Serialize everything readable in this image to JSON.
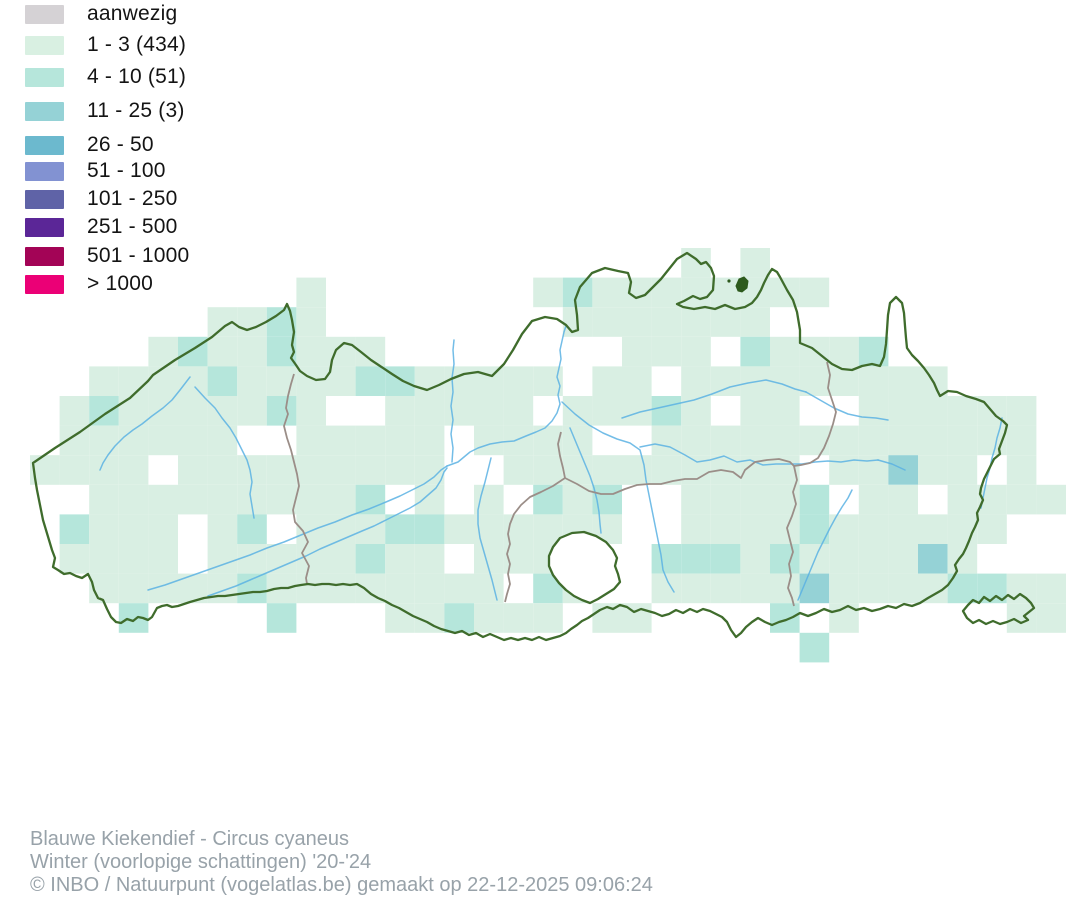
{
  "legend": {
    "items": [
      {
        "label": "aanwezig",
        "color": "#d5d2d5"
      },
      {
        "label": "1 - 3 (434)",
        "color": "#d9f0e2"
      },
      {
        "label": "4 - 10 (51)",
        "color": "#b6e6db"
      },
      {
        "label": "11 - 25 (3)",
        "color": "#95d2d6"
      },
      {
        "label": "26 - 50",
        "color": "#6cb9ce"
      },
      {
        "label": "51 - 100",
        "color": "#8292d2"
      },
      {
        "label": "101 - 250",
        "color": "#5f63a7"
      },
      {
        "label": "251 - 500",
        "color": "#5b2697"
      },
      {
        "label": "501 - 1000",
        "color": "#a30456"
      },
      {
        "label": "> 1000",
        "color": "#eb0076"
      }
    ]
  },
  "footer": {
    "line1": "Blauwe Kiekendief - Circus cyaneus",
    "line2": "Winter (voorlopige schattingen) '20-'24",
    "line3": "© INBO / Natuurpunt (vogelatlas.be) gemaakt op 22-12-2025 09:06:24"
  },
  "map": {
    "colors": {
      "outline": "#3f6c2c",
      "province_border": "#9b8e88",
      "river": "#5ab2e3",
      "forest": "#2d5a1d",
      "enclave_fill": "#ffffff",
      "level1": "#d9efe3",
      "level2": "#b5e6db",
      "level3": "#95d2d6"
    },
    "grid": {
      "x0": 30,
      "y0": 248,
      "size": 29.6,
      "levels": {
        "1": "level1",
        "2": "level2",
        "3": "level3"
      },
      "rows": [
        "......................1.1..........",
        ".........1.......1211111111........",
        "......1121........1111111..........",
        "....12112111........111.21112......",
        "..1111211112211111.11.111111111....",
        ".121111121..11111.11121 11..111111.",
        ".111111..11111.1111..1111111111111.",
        "1111.111111111..1111111111.11311.1.",
        "..1111111112 1.1.212..11112 11.1111..",
        ".2111 12.11122111111..11112111111...",
        ".1111.11111211.111...22212111131...",
        "..11111211111111 21..11111311112211.",
        "...2....2...112111 11....2.1.....11.",
        "..........................2........"
      ]
    },
    "outline": "M 33 463 L 55 448 80 432 105 414 130 398 148 381 153 375 175 360 195 348 212 337 225 326 232 322 239 327 247 330 256 327 266 322 276 316 284 310 287 304 290 311 292 320 294 332 292 345 294 352 291 358 296 365 300 371 307 376 316 380 325 379 330 372 332 360 336 350 344 343 352 345 361 352 371 360 380 366 392 374 403 381 414 386 427 390 439 385 451 379 464 374 478 372 492 376 504 364 513 350 522 334 532 321 545 317 557 319 566 325 572 332 578 330 577 315 575 300 580 287 592 273 605 268 618 271 628 273 631 282 629 293 636 298 645 295 653 287 661 279 669 269 677 259 687 253 696 259 701 264 706 262 711 268 714 276 713 290 707 297 700 299 693 296 684 301 677 304 683 307 694 309 705 307 715 309 725 305 735 309 745 307 752 303 757 297 761 290 764 283 768 275 772 269 777 272 780 277 787 290 793 300 797 312 800 330 800 343 812 348 822 356 832 364 842 369 852 370 862 366 872 364 880 366 884 357 886 344 887 330 888 315 890 303 896 297 902 303 904 313 905 326 906 338 907 348 912 355 918 361 924 368 929 375 934 383 937 390 940 396 948 391 957 392 966 396 976 399 984 402 990 409 996 416 1003 421 1007 425 1005 433 1002 441 999 449 1000 454 994 459 991 465 988 471 984 479 981 488 980 494 983 500 980 507 977 513 978 520 975 527 972 533 969 541 966 548 963 554 959 559 955 565 957 571 953 578 948 585 942 590 935 594 928 598 920 603 912 606 904 604 896 608 888 606 880 609 872 611 864 608 856 610 848 606 840 610 832 612 824 609 816 613 808 616 800 613 793 617 786 620 779 622 772 625 765 622 758 618 752 622 746 627 741 633 736 637 731 630 727 622 722 617 716 614 710 611 703 609 697 612 690 609 683 613 676 610 669 614 662 616 655 613 648 611 641 609 634 612 627 607 620 605 613 609 607 607 600 610 594 614 588 618 582 621 577 625 571 629 566 633 560 636 553 638 546 640 539 637 532 640 525 638 518 640 511 638 504 640 497 637 490 634 483 637 476 633 469 635 462 631 455 633 448 631 441 629 434 626 427 622 420 619 413 616 406 612 399 608 392 605 385 601 378 598 371 594 364 588 357 584 350 585 343 584 336 585 329 584 322 584 315 585 308 584 301 585 295 586 288 588 281 588 274 589 267 591 260 592 253 592 246 593 239 594 232 595 225 596 218 596 211 597 204 598 197 600 190 602 184 604 178 606 172 607 167 605 162 606 157 608 152 617 148 620 143 618 138 617 133 621 127 619 121 623 116 622 111 617 107 609 103 600 98 598 94 590 92 582 88 574 82 578 76 576 70 573 64 574 58 570 53 567 55 558 52 550 49 540 46 530 43 520 41 510 39 500 37 490 35 478 Z",
    "enclave": "M 560 538 L 572 533 584 532 596 536 606 542 613 550 617 558 615 566 618 574 620 582 614 589 606 594 598 599 590 603 582 600 574 596 566 590 559 583 553 575 549 566 549 556 553 547 Z",
    "exclave": "M 963 611 L 968 605 973 600 979 603 984 597 990 601 996 596 1002 600 1008 595 1014 599 1020 594 1026 598 1031 603 1034 608 1029 612 1024 616 1028 620 1021 623 1014 619 1007 622 1000 624 993 621 986 624 979 620 973 623 967 618 Z",
    "forest_blob": "M 736 286 L 739 279 744 277 748 281 747 288 742 292 738 291 Z",
    "province_borders": [
      "M 294 374 L 291 384 288 396 286 408 288 414 284 426 287 438 291 450 294 462 297 474 299 486 296 498 293 510 295 522 303 531 308 542 302 553 309 566 306 578 307 584",
      "M 561 432 L 558 444 560 456 563 468 565 478 553 486 541 492 530 497 521 505 514 514 510 524 508 534 510 544 507 554 510 564 508 574 510 584 507 594 505 602",
      "M 565 478 L 577 484 589 491 601 494 613 494 625 489 637 485 649 484 661 484 673 481 685 479 697 479 709 472 721 470 733 472 741 478 745 470 755 462 767 460 779 459 790 462 794 466",
      "M 827 362 L 830 375 828 388 832 400 836 412 833 424 829 436 824 448 818 458 810 463 801 465 794 466 797 480 793 492 796 504 792 516 787 528 790 540 793 552 789 564 791 576 788 588 792 598 794 606"
    ],
    "rivers": [
      "M 190 377 L 180 390 172 400 163 408 152 416 142 424 133 430 124 437 115 446 108 455 103 463 100 470",
      "M 195 387 L 205 398 215 408 222 418 230 428 236 438 242 450 247 460 250 470 252 482 250 494 252 506 254 518",
      "M 148 590 L 165 585 182 579 199 573 216 567 233 561 250 555 267 548 284 542 301 535 318 528 335 522 352 515 369 509 386 502 400 496 412 490 424 484 434 477 441 470 447 466",
      "M 208 596 L 222 591 236 586 250 580 264 574 278 568 292 562 306 556 320 549 334 543 348 537 362 531 374 526 386 520 398 514 410 508 420 502 428 495 436 488 441 480 444 472 447 468",
      "M 447 466 L 458 462 470 452 478 448 490 444 502 442 514 441 526 436 536 432 545 428 552 421 557 413 560 404 558 395 560 386 557 377 559 368 561 359 560 350 562 341 564 332 566 326",
      "M 452 462 L 453 448 451 434 453 420 451 406 453 392 452 378 454 364 453 350 454 340",
      "M 497 600 L 492 580 488 566 484 552 480 538 478 524 478 510 481 496 485 482 488 470 491 458",
      "M 562 402 L 575 414 589 425 603 433 617 439 630 443 640 450 644 465 646 480 649 495 652 510 655 525 658 540 661 555 663 570 668 582 674 592",
      "M 570 428 L 575 440 580 452 585 464 590 476 594 488 597 500 599 512 600 524 601 533",
      "M 622 418 L 640 412 658 408 676 404 694 400 712 394 730 387 748 383 766 380 782 384 795 389 806 392",
      "M 806 392 L 820 400 834 408 848 414 862 417 876 418 888 420",
      "M 640 447 L 655 444 670 447 685 455 697 462 710 460 724 456 737 462 750 460 763 465 776 464 789 464 802 464 815 462 828 461 841 462 854 460 867 461 878 460",
      "M 878 460 L 892 464 905 470",
      "M 798 600 L 803 588 808 576 813 564 818 552 824 540 830 528 836 517 842 507 848 498 852 490",
      "M 1002 418 L 1000 428 997 438 995 448 992 458 990 468 987 478 985 488 983 498 981 508"
    ]
  }
}
